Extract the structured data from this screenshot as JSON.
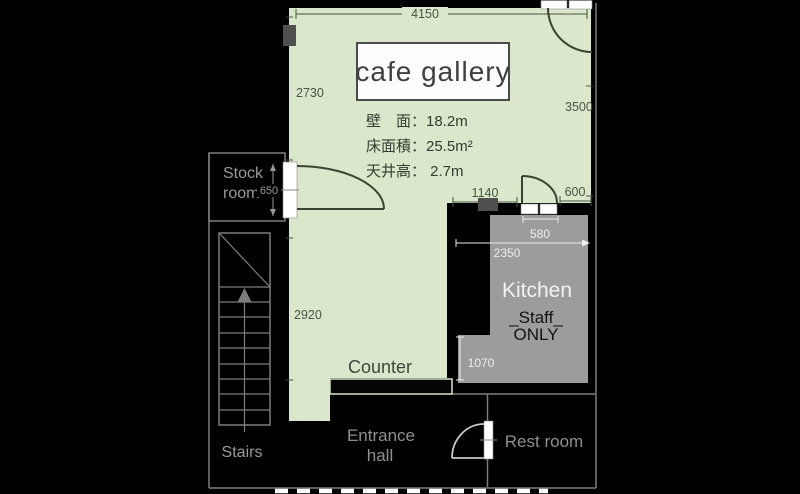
{
  "plan": {
    "title": "cafe gallery",
    "specs": {
      "wall_length": "壁　面：18.2m",
      "floor_area": "床面積：25.5m²",
      "ceiling_height": "天井高：  2.7m"
    },
    "rooms": {
      "stock_line1": "Stock",
      "stock_line2": "room",
      "stairs": "Stairs",
      "counter": "Counter",
      "entrance_line1": "Entrance",
      "entrance_line2": "hall",
      "rest_room": "Rest room",
      "kitchen": "Kitchen",
      "staff_line1": "_Staff_",
      "staff_line2": "ONLY"
    },
    "dimensions_mm": {
      "top_width": "4150",
      "left_upper": "2730",
      "right_height": "3500",
      "door_offset": "1140",
      "right_door": "600",
      "stock_door": "650",
      "kitchen_door": "580",
      "kitchen_width": "2350",
      "kitchen_passage": "1070",
      "left_lower": "2920"
    },
    "colors": {
      "background": "#000000",
      "gallery_floor": "#dbe7ca",
      "kitchen_floor": "#9c9c9c",
      "outline": "#7d7d7d",
      "label_gray": "#9a9a9a",
      "dim_dark": "#4a5345",
      "dim_light": "#ededed",
      "door_white": "#ffffff"
    }
  }
}
